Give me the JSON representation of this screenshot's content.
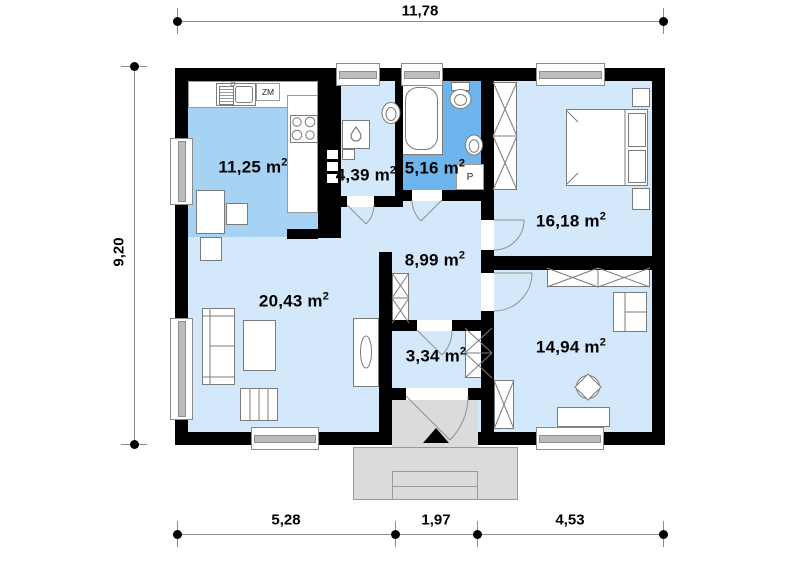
{
  "dimensions": {
    "top": "11,78",
    "left": "9,20",
    "bottom": [
      "5,28",
      "1,97",
      "4,53"
    ]
  },
  "rooms": [
    {
      "id": "kitchen",
      "area": "11,25",
      "unit": "m",
      "exp": "2"
    },
    {
      "id": "utility",
      "area": "4,39",
      "unit": "m",
      "exp": "2"
    },
    {
      "id": "bathroom",
      "area": "5,16",
      "unit": "m",
      "exp": "2"
    },
    {
      "id": "bedroom-right",
      "area": "16,18",
      "unit": "m",
      "exp": "2"
    },
    {
      "id": "hall",
      "area": "8,99",
      "unit": "m",
      "exp": "2"
    },
    {
      "id": "living-room",
      "area": "20,43",
      "unit": "m",
      "exp": "2"
    },
    {
      "id": "vestibule",
      "area": "3,34",
      "unit": "m",
      "exp": "2"
    },
    {
      "id": "bedroom-bottom",
      "area": "14,94",
      "unit": "m",
      "exp": "2"
    }
  ],
  "labels": {
    "dishwasher": "ZM",
    "washing_machine": "P"
  },
  "colors": {
    "wall": "#000000",
    "floor": "#d4e8fb",
    "kitchen_floor": "#a6d3f4",
    "bathroom_floor": "#6db5ec",
    "porch": "#dbdbdb",
    "furniture_outline": "#7b7b7b",
    "dimension_line": "#8c8c8c",
    "text": "#000000"
  },
  "fixtures": [
    "kitchen-sink",
    "dishwasher",
    "stove",
    "dining-table",
    "chair",
    "boiler",
    "washbasin",
    "bathtub",
    "toilet",
    "washing-machine",
    "wardrobe",
    "double-bed",
    "nightstand",
    "sofa",
    "coffee-table",
    "bench",
    "sideboard",
    "desk",
    "desk-chair",
    "armchair",
    "porch-steps",
    "entrance-arrow",
    "door-arc",
    "window",
    "chimney"
  ]
}
